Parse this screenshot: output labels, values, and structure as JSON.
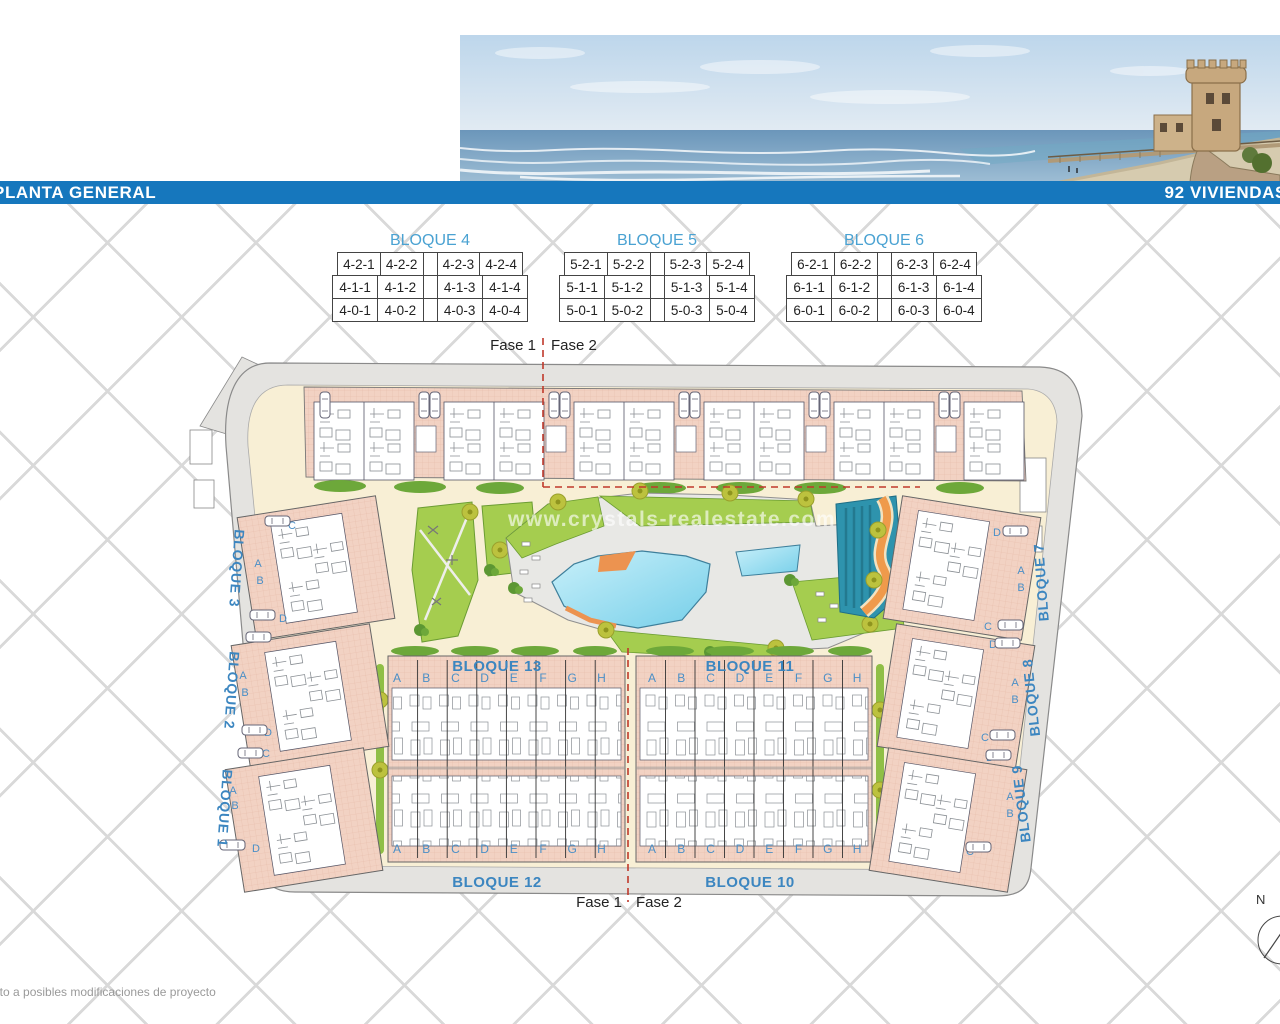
{
  "header": {
    "left_title": "PLANTA GENERAL",
    "right_title": "92 VIVIENDAS"
  },
  "unit_tables": [
    {
      "title": "BLOQUE 4",
      "rows": [
        [
          "4-2-1",
          "4-2-2",
          "4-2-3",
          "4-2-4"
        ],
        [
          "4-1-1",
          "4-1-2",
          "4-1-3",
          "4-1-4"
        ],
        [
          "4-0-1",
          "4-0-2",
          "4-0-3",
          "4-0-4"
        ]
      ]
    },
    {
      "title": "BLOQUE 5",
      "rows": [
        [
          "5-2-1",
          "5-2-2",
          "5-2-3",
          "5-2-4"
        ],
        [
          "5-1-1",
          "5-1-2",
          "5-1-3",
          "5-1-4"
        ],
        [
          "5-0-1",
          "5-0-2",
          "5-0-3",
          "5-0-4"
        ]
      ]
    },
    {
      "title": "BLOQUE 6",
      "rows": [
        [
          "6-2-1",
          "6-2-2",
          "6-2-3",
          "6-2-4"
        ],
        [
          "6-1-1",
          "6-1-2",
          "6-1-3",
          "6-1-4"
        ],
        [
          "6-0-1",
          "6-0-2",
          "6-0-3",
          "6-0-4"
        ]
      ]
    }
  ],
  "site_plan": {
    "phase_labels": {
      "fase1": "Fase 1",
      "fase2": "Fase 2"
    },
    "row_blocks": {
      "top_left": "BLOQUE 13",
      "top_right": "BLOQUE 11",
      "bottom_left": "BLOQUE 12",
      "bottom_right": "BLOQUE 10"
    },
    "left_road_blocks": [
      "BLOQUE 3",
      "BLOQUE 2",
      "BLOQUE 1"
    ],
    "right_road_blocks": [
      "BLOQUE 7",
      "BLOQUE 8",
      "BLOQUE 9"
    ],
    "unit_letters": [
      "A",
      "B",
      "C",
      "D",
      "E",
      "F",
      "G",
      "H"
    ],
    "side_letters_left": [
      "C",
      "A",
      "B",
      "D"
    ],
    "side_letters_right": [
      "D",
      "A",
      "B",
      "C"
    ],
    "compass_north": "N"
  },
  "watermark": "www.crystals-realestate.com",
  "footnote": "eto a posibles modificaciones de proyecto",
  "colors": {
    "title_bar": "#1677bd",
    "table_title_blue": "#4aa2d2",
    "plan_label_blue": "#3c86c0",
    "phase_line_red": "#c0392b",
    "building_pink": "#f2d2c3",
    "lawn_green": "#a5cd4f",
    "pool_blue": "#76cfe9",
    "water_feature_teal": "#2e93ad",
    "river_orange": "#ef9a4b",
    "ground_cream": "#f8efd5"
  }
}
